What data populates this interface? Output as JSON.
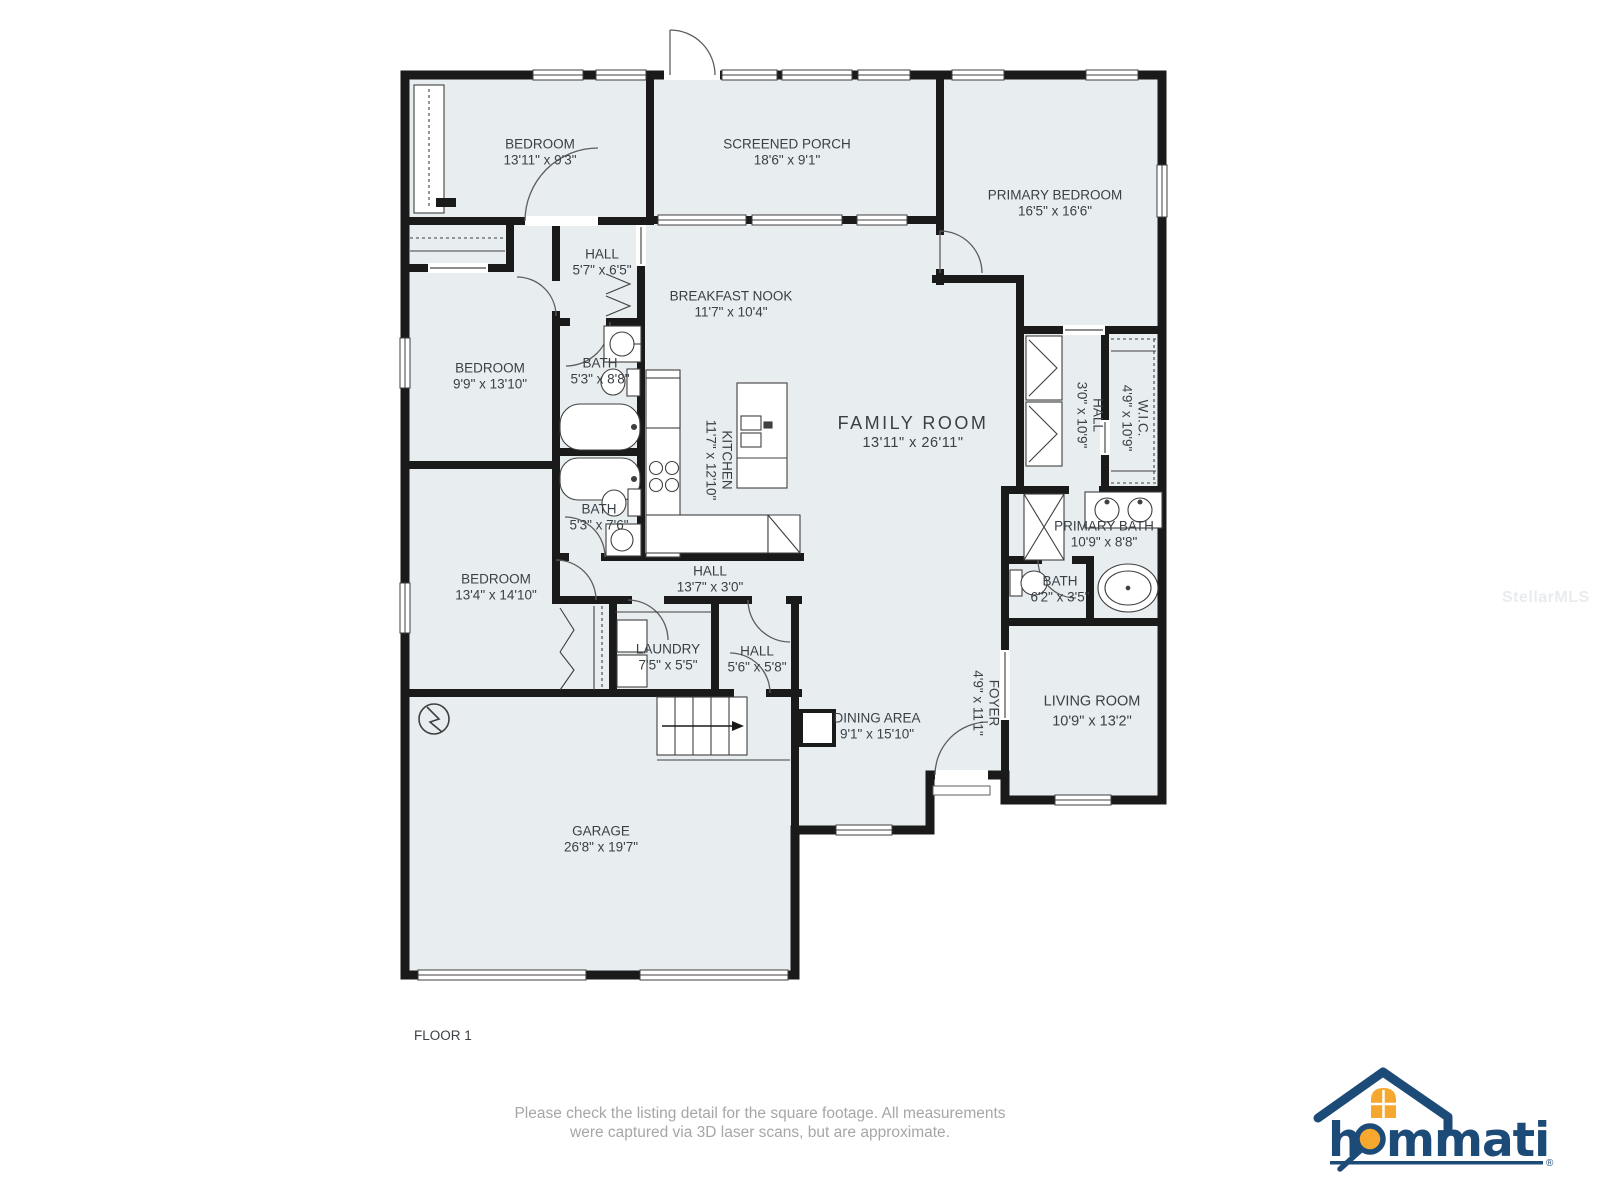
{
  "floor_plan": {
    "floor_label": "FLOOR 1",
    "rooms": [
      {
        "name": "BEDROOM",
        "dims": "13'11\" x 9'3\""
      },
      {
        "name": "SCREENED PORCH",
        "dims": "18'6\" x 9'1\""
      },
      {
        "name": "PRIMARY BEDROOM",
        "dims": "16'5\" x 16'6\""
      },
      {
        "name": "HALL",
        "dims": "5'7\" x 6'5\""
      },
      {
        "name": "BREAKFAST NOOK",
        "dims": "11'7\" x 10'4\""
      },
      {
        "name": "BEDROOM",
        "dims": "9'9\" x 13'10\""
      },
      {
        "name": "BATH",
        "dims": "5'3\" x 8'8\""
      },
      {
        "name": "KITCHEN",
        "dims": "11'7\" x 12'10\""
      },
      {
        "name": "FAMILY ROOM",
        "dims": "13'11\" x 26'11\""
      },
      {
        "name": "HALL",
        "dims": "3'0\" x 10'9\""
      },
      {
        "name": "W.I.C.",
        "dims": "4'9\" x 10'9\""
      },
      {
        "name": "PRIMARY BATH",
        "dims": "10'9\" x 8'8\""
      },
      {
        "name": "BATH",
        "dims": "5'3\" x 7'6\""
      },
      {
        "name": "BEDROOM",
        "dims": "13'4\" x 14'10\""
      },
      {
        "name": "HALL",
        "dims": "13'7\" x 3'0\""
      },
      {
        "name": "LAUNDRY",
        "dims": "7'5\" x 5'5\""
      },
      {
        "name": "HALL",
        "dims": "5'6\" x 5'8\""
      },
      {
        "name": "BATH",
        "dims": "6'2\" x 3'5\""
      },
      {
        "name": "FOYER",
        "dims": "4'9\" x 11'1\""
      },
      {
        "name": "DINING AREA",
        "dims": "9'1\" x 15'10\""
      },
      {
        "name": "LIVING ROOM",
        "dims": "10'9\" x 13'2\""
      },
      {
        "name": "GARAGE",
        "dims": "26'8\" x 19'7\""
      }
    ]
  },
  "footer": {
    "line1": "Please check the listing detail for the square footage. All measurements",
    "line2": "were captured via 3D laser scans, but are approximate."
  },
  "watermark": "StellarMLS",
  "logo": {
    "text_h": "h",
    "text_rest": "mmati",
    "registered": "®",
    "brand": "hommati"
  },
  "colors": {
    "room_fill": "#e8edf0",
    "wall": "#1a1a1a",
    "label_text": "#3a4045",
    "footer_text": "#a6a6a6",
    "logo_navy": "#1d4b77",
    "logo_orange": "#f5a72e"
  }
}
